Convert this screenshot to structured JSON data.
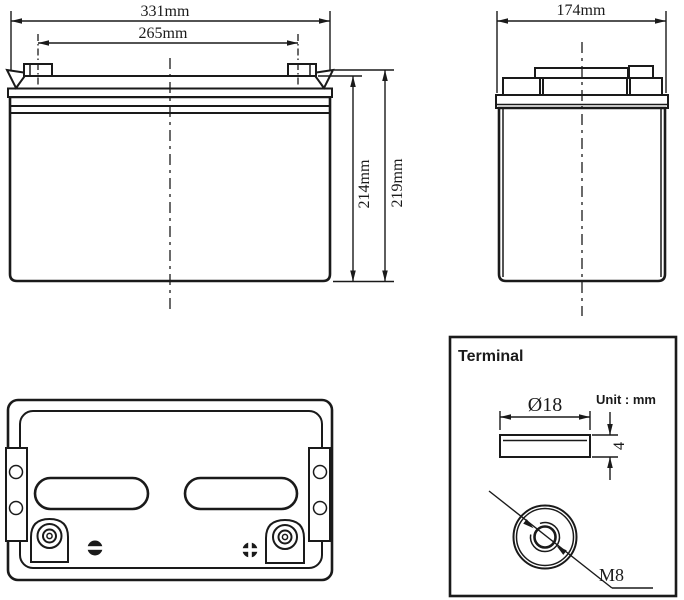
{
  "colors": {
    "line": "#1a1a1a",
    "background": "#ffffff"
  },
  "front_view": {
    "overall_width": "331mm",
    "terminal_pitch": "265mm",
    "body_height": "214mm",
    "overall_height": "219mm"
  },
  "side_view": {
    "overall_depth": "174mm"
  },
  "terminal_detail": {
    "title": "Terminal",
    "unit_note": "Unit : mm",
    "diameter": "Ø18",
    "thickness": "4",
    "thread_size": "M8"
  }
}
